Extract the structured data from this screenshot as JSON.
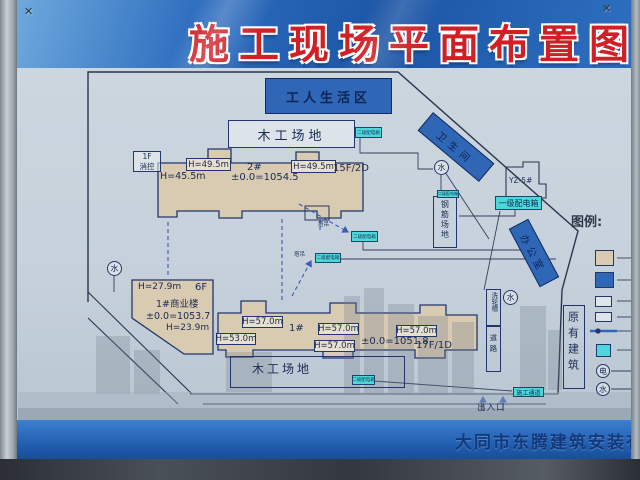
{
  "colors": {
    "accent-red": "#d11f26",
    "area-blue": "#2f66b5",
    "building-fill": "#d9cab2",
    "cyan": "#4ed6da",
    "line-navy": "#23366b"
  },
  "header": {
    "title": "施工现场平面布置图"
  },
  "footer": {
    "company": "大同市东腾建筑安装有"
  },
  "plan": {
    "areas": {
      "workers_living": "工人生活区",
      "carpentry": "木工场地",
      "rebar_yard": "钢筋场地",
      "toilet": "卫生间",
      "office": "办公室",
      "existing_building": "原有建筑",
      "wheel_wash": "洗轮槽",
      "road": "道路",
      "entrance": "出入口",
      "fire_control_line1": "1F",
      "fire_control_line2": "消控",
      "yz5": "YZ-5#"
    },
    "building2": {
      "name": "2#",
      "height_main": "H=45.5m",
      "height_top": "H=49.5m",
      "elevation": "±0.0=1054.5",
      "floors": "15F/2D"
    },
    "building1s": {
      "name": "1#商业楼",
      "height_main": "H=27.9m",
      "floors": "6F",
      "elevation": "±0.0=1053.7",
      "height_low": "H=23.9m"
    },
    "building1": {
      "name": "1#",
      "height_left": "H=53.0m",
      "height_top": "H=57.0m",
      "elevation": "±0.0=1051.8",
      "floors": "17F/1D"
    },
    "boxes": {
      "level1": "一级配电箱",
      "level2": "二级配电箱",
      "passage": "施工通道",
      "crane": "塔吊"
    },
    "symbols": {
      "water": "水",
      "electric": "电"
    }
  },
  "legend": {
    "title": "图例:"
  }
}
